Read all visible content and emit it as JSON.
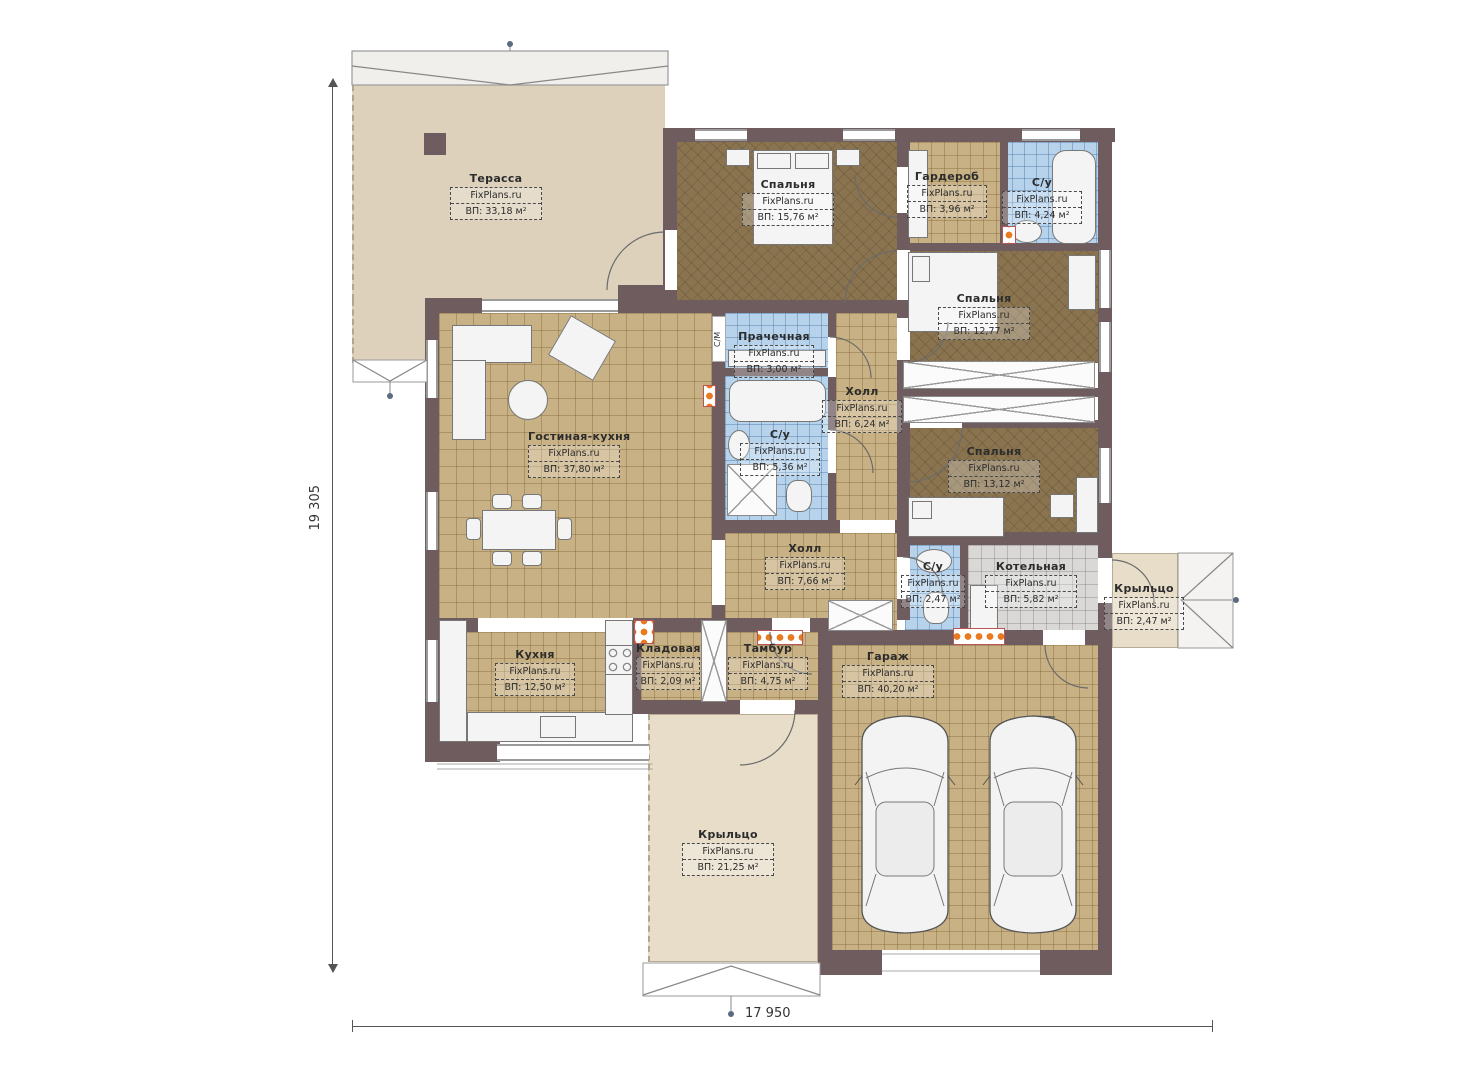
{
  "watermark": "FixPlans.ru",
  "dimensions": {
    "height_label": "19 305",
    "width_label": "17 950"
  },
  "labels": {
    "washing_machine": "С/М"
  },
  "rooms": [
    {
      "name": "Терасса",
      "area": "ВП: 33,18 м²"
    },
    {
      "name": "Спальня",
      "area": "ВП: 15,76 м²"
    },
    {
      "name": "Гардероб",
      "area": "ВП: 3,96 м²"
    },
    {
      "name": "С/у",
      "area": "ВП: 4,24 м²"
    },
    {
      "name": "Спальня",
      "area": "ВП: 12,77 м²"
    },
    {
      "name": "Прачечная",
      "area": "ВП: 3,00 м²"
    },
    {
      "name": "Холл",
      "area": "ВП: 6,24 м²"
    },
    {
      "name": "С/у",
      "area": "ВП: 5,36 м²"
    },
    {
      "name": "Гостиная-кухня",
      "area": "ВП: 37,80 м²"
    },
    {
      "name": "Спальня",
      "area": "ВП: 13,12 м²"
    },
    {
      "name": "Холл",
      "area": "ВП: 7,66 м²"
    },
    {
      "name": "С/у",
      "area": "ВП: 2,47 м²"
    },
    {
      "name": "Котельная",
      "area": "ВП: 5,82 м²"
    },
    {
      "name": "Крыльцо",
      "area": "ВП: 2,47 м²"
    },
    {
      "name": "Кухня",
      "area": "ВП: 12,50 м²"
    },
    {
      "name": "Кладовая",
      "area": "ВП: 2,09 м²"
    },
    {
      "name": "Тамбур",
      "area": "ВП: 4,75 м²"
    },
    {
      "name": "Гараж",
      "area": "ВП: 40,20 м²"
    },
    {
      "name": "Крыльцо",
      "area": "ВП: 21,25 м²"
    }
  ],
  "colors": {
    "wall": "#6e5c5f",
    "tile-tan": "#c8b184",
    "wood": "#8a7450",
    "tile-blue": "#b7d3ec",
    "tile-gray": "#d9d8d6",
    "beige": "#ddd1bb",
    "beige-light": "#e7ddc9",
    "radiator": "#e87a20"
  }
}
